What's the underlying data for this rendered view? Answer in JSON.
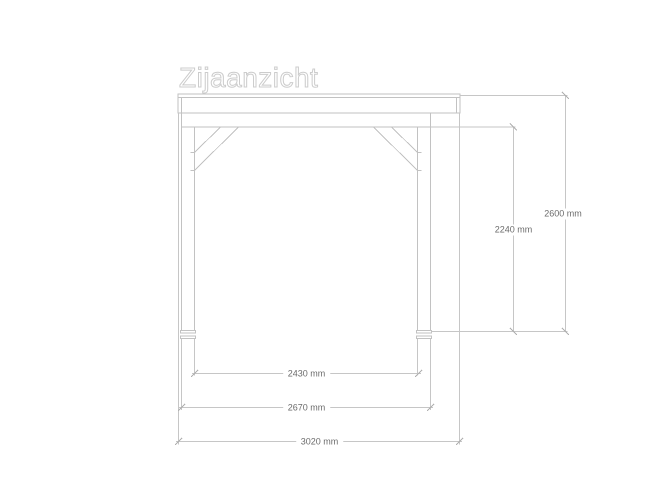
{
  "title": "Zijaanzicht",
  "view_type": "technical side-view drawing of a timber canopy / veranda frame",
  "dimension_labels": {
    "inner_post_span": "2430 mm",
    "outer_post_span": "2670 mm",
    "roof_length": "3020 mm",
    "underside_beam_height": "2240 mm",
    "total_height": "2600 mm"
  },
  "colors": {
    "line": "#c6c6c6",
    "structure_line": "#c2c2c2",
    "tick": "#b0b0b0",
    "dimension_text": "#6b6b6b",
    "title_outline": "#cccccc",
    "background": "#ffffff"
  }
}
